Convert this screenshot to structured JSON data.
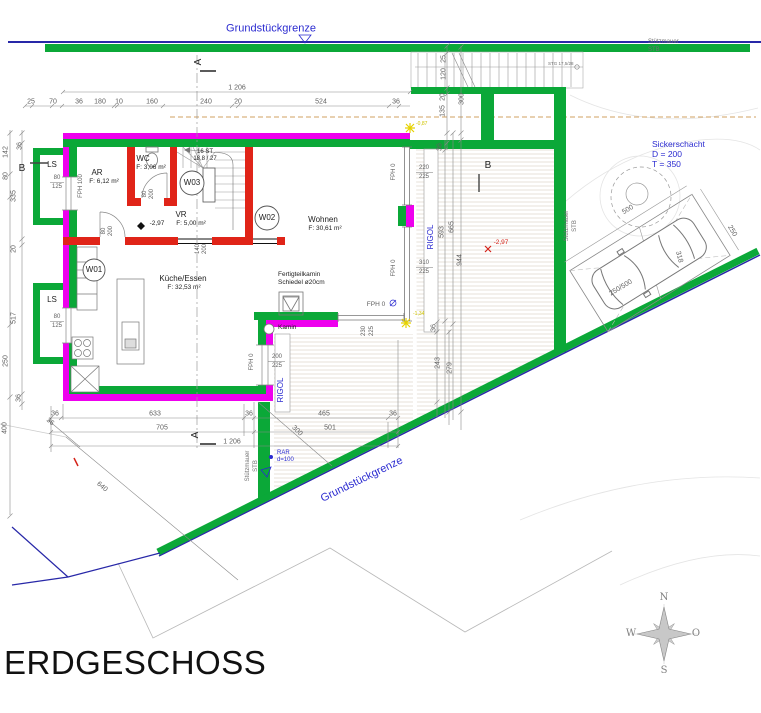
{
  "title": "ERDGESCHOSS",
  "compass": {
    "n": "N",
    "o": "O",
    "s": "S",
    "w": "W"
  },
  "site": {
    "boundary_top": "Grundstückgrenze",
    "boundary_bottom": "Grundstückgrenze",
    "retaining1_l1": "Stützmauer",
    "retaining1_l2": "STB",
    "retaining2_l1": "Stützmauer",
    "retaining2_l2": "STB",
    "retaining3_l1": "Stützmauer",
    "retaining3_l2": "STB",
    "sicker_l1": "Sickerschacht",
    "sicker_l2": "D = 200",
    "sicker_l3": "T = 350",
    "rar_l1": "RAR",
    "rar_l2": "d=100",
    "rigol1": "RIGOL",
    "rigol2": "RIGOL",
    "level_terrace": "-2,97",
    "level_top": "-0,87",
    "level_mid": "-1,34",
    "ext_stair_note": "STG 17,5/28"
  },
  "sections": {
    "a_top": "A",
    "a_bottom": "A",
    "b_left": "B",
    "b_right": "B"
  },
  "rooms": {
    "ar": {
      "name": "AR",
      "area": "F: 6,12 m²"
    },
    "wc": {
      "name": "WC",
      "area": "F: 3,06 m²"
    },
    "vr": {
      "name": "VR",
      "area": "F: 5,00 m²",
      "level": "-2,97"
    },
    "kueche": {
      "name": "Küche/Essen",
      "area": "F: 32,53 m²"
    },
    "wohnen": {
      "name": "Wohnen",
      "area": "F: 30,61 m²"
    }
  },
  "stairs": {
    "line1": "16 ST",
    "line2": "18,8 / 27"
  },
  "tags": {
    "w01": "W01",
    "w02": "W02",
    "w03": "W03"
  },
  "chimney": {
    "note_l1": "Fertigteilkamin",
    "note_l2": "Schiedel ø20cm",
    "label": "Kamin"
  },
  "openings": {
    "fph100": "FPH 100",
    "fph0_a": "FPH 0",
    "fph0_b": "FPH 0",
    "fph0_c": "FPH 0",
    "fph0_d": "FPH 0",
    "ls1": "LS",
    "ls2": "LS",
    "ls1_w": "80",
    "ls1_h": "125",
    "ls2_w": "80",
    "ls2_h": "125",
    "win_e1_w": "220",
    "win_e1_h": "225",
    "win_e2_w": "310",
    "win_e2_h": "225",
    "win_s_w": "230",
    "win_s_h": "225",
    "win_k_w": "200",
    "win_k_h": "225",
    "door1_w": "80",
    "door1_h": "200",
    "door2_w": "80",
    "door2_h": "200",
    "door3_w": "140",
    "door3_h": "200"
  },
  "dims": {
    "top_total": "1 206",
    "top": [
      "25",
      "70",
      "36",
      "180",
      "10",
      "160",
      "240",
      "20",
      "524",
      "36"
    ],
    "right_top": [
      "25",
      "120",
      "20",
      "135",
      "300",
      "36"
    ],
    "right_mid": [
      "593",
      "665",
      "944",
      "36",
      "243",
      "279"
    ],
    "left_inner": [
      "36",
      "335",
      "20",
      "517",
      "36"
    ],
    "left_outer": [
      "142",
      "80",
      "250",
      "400"
    ],
    "bottom1": [
      "36",
      "633",
      "36",
      "465",
      "36"
    ],
    "bottom2": [
      "705",
      "501"
    ],
    "bottom_total": "1 206",
    "diag": [
      "36",
      "300",
      "640"
    ],
    "parking": {
      "len": "500",
      "wid": "250",
      "diag": "318",
      "size": "250/500"
    }
  }
}
